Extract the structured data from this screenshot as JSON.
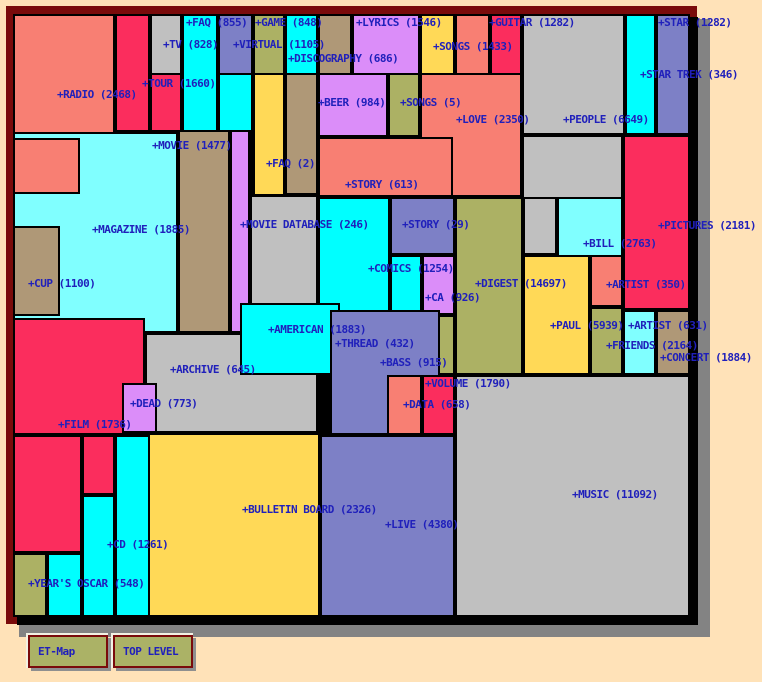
{
  "page": {
    "background": "#ffe2b8"
  },
  "toolbar": {
    "etmap_label": "ET-Map",
    "toplevel_label": "TOP LEVEL"
  },
  "map": {
    "frame_color": "#7a0b0b",
    "shadow_color": "#838383",
    "label_color": "#2020bb",
    "palette": {
      "salmon": "#f87f73",
      "crimson": "#fb2d5d",
      "gray": "#c0c0c0",
      "cyan": "#00ffff",
      "lcyan": "#80ffff",
      "violet": "#db8df9",
      "slate": "#7d80c6",
      "olive": "#acb164",
      "gold": "#ffd957",
      "tan": "#af9877"
    },
    "tiles": [
      {
        "name": "radio",
        "x": 13,
        "y": 14,
        "w": 102,
        "h": 126,
        "c": "salmon"
      },
      {
        "name": "magazine",
        "x": 13,
        "y": 132,
        "w": 165,
        "h": 201,
        "c": "lcyan"
      },
      {
        "name": "radio-lower",
        "x": 13,
        "y": 138,
        "w": 67,
        "h": 56,
        "c": "salmon"
      },
      {
        "name": "cup",
        "x": 13,
        "y": 226,
        "w": 47,
        "h": 90,
        "c": "tan"
      },
      {
        "name": "tour",
        "x": 115,
        "y": 14,
        "w": 35,
        "h": 118,
        "c": "crimson"
      },
      {
        "name": "tv",
        "x": 150,
        "y": 14,
        "w": 32,
        "h": 61,
        "c": "gray"
      },
      {
        "name": "tour-right",
        "x": 150,
        "y": 73,
        "w": 32,
        "h": 59,
        "c": "crimson"
      },
      {
        "name": "faq-855",
        "x": 182,
        "y": 14,
        "w": 36,
        "h": 118,
        "c": "cyan"
      },
      {
        "name": "virtual",
        "x": 218,
        "y": 14,
        "w": 35,
        "h": 61,
        "c": "slate"
      },
      {
        "name": "virtual-lower",
        "x": 218,
        "y": 73,
        "w": 35,
        "h": 59,
        "c": "cyan"
      },
      {
        "name": "game",
        "x": 253,
        "y": 14,
        "w": 32,
        "h": 61,
        "c": "olive"
      },
      {
        "name": "game-right",
        "x": 285,
        "y": 14,
        "w": 33,
        "h": 61,
        "c": "cyan"
      },
      {
        "name": "discography-top",
        "x": 318,
        "y": 14,
        "w": 34,
        "h": 61,
        "c": "tan"
      },
      {
        "name": "lyrics",
        "x": 352,
        "y": 14,
        "w": 68,
        "h": 61,
        "c": "violet"
      },
      {
        "name": "songs-1433",
        "x": 420,
        "y": 14,
        "w": 35,
        "h": 61,
        "c": "gold"
      },
      {
        "name": "songs-right",
        "x": 455,
        "y": 14,
        "w": 35,
        "h": 61,
        "c": "salmon"
      },
      {
        "name": "guitar",
        "x": 490,
        "y": 14,
        "w": 32,
        "h": 61,
        "c": "crimson"
      },
      {
        "name": "people",
        "x": 522,
        "y": 14,
        "w": 103,
        "h": 121,
        "c": "gray"
      },
      {
        "name": "people-cyan-strip",
        "x": 625,
        "y": 14,
        "w": 31,
        "h": 121,
        "c": "cyan"
      },
      {
        "name": "star",
        "x": 656,
        "y": 14,
        "w": 34,
        "h": 121,
        "c": "slate"
      },
      {
        "name": "faq-2",
        "x": 253,
        "y": 73,
        "w": 32,
        "h": 123,
        "c": "gold"
      },
      {
        "name": "discography",
        "x": 285,
        "y": 73,
        "w": 33,
        "h": 122,
        "c": "tan"
      },
      {
        "name": "beer",
        "x": 318,
        "y": 73,
        "w": 70,
        "h": 64,
        "c": "violet"
      },
      {
        "name": "songs-5",
        "x": 388,
        "y": 73,
        "w": 32,
        "h": 64,
        "c": "olive"
      },
      {
        "name": "love",
        "x": 420,
        "y": 73,
        "w": 102,
        "h": 124,
        "c": "salmon"
      },
      {
        "name": "movie",
        "x": 178,
        "y": 130,
        "w": 52,
        "h": 203,
        "c": "tan"
      },
      {
        "name": "movie-database-col",
        "x": 230,
        "y": 130,
        "w": 20,
        "h": 203,
        "c": "violet"
      },
      {
        "name": "movie-database",
        "x": 250,
        "y": 195,
        "w": 68,
        "h": 138,
        "c": "gray"
      },
      {
        "name": "story-613",
        "x": 318,
        "y": 137,
        "w": 135,
        "h": 60,
        "c": "salmon"
      },
      {
        "name": "people-lower",
        "x": 522,
        "y": 135,
        "w": 101,
        "h": 75,
        "c": "gray"
      },
      {
        "name": "pictures",
        "x": 623,
        "y": 135,
        "w": 67,
        "h": 175,
        "c": "crimson"
      },
      {
        "name": "comics",
        "x": 318,
        "y": 197,
        "w": 72,
        "h": 118,
        "c": "cyan"
      },
      {
        "name": "comics-ext",
        "x": 390,
        "y": 255,
        "w": 32,
        "h": 60,
        "c": "cyan"
      },
      {
        "name": "story-29",
        "x": 390,
        "y": 197,
        "w": 65,
        "h": 58,
        "c": "slate"
      },
      {
        "name": "ca",
        "x": 422,
        "y": 255,
        "w": 33,
        "h": 60,
        "c": "violet"
      },
      {
        "name": "digest",
        "x": 455,
        "y": 197,
        "w": 68,
        "h": 178,
        "c": "olive"
      },
      {
        "name": "digest-ext",
        "x": 422,
        "y": 315,
        "w": 33,
        "h": 60,
        "c": "olive"
      },
      {
        "name": "people-tongue",
        "x": 523,
        "y": 197,
        "w": 34,
        "h": 58,
        "c": "gray"
      },
      {
        "name": "bill",
        "x": 557,
        "y": 197,
        "w": 66,
        "h": 110,
        "c": "lcyan"
      },
      {
        "name": "paul",
        "x": 523,
        "y": 255,
        "w": 67,
        "h": 120,
        "c": "gold"
      },
      {
        "name": "artist-350",
        "x": 590,
        "y": 255,
        "w": 33,
        "h": 52,
        "c": "salmon"
      },
      {
        "name": "artist-631",
        "x": 590,
        "y": 307,
        "w": 33,
        "h": 68,
        "c": "olive"
      },
      {
        "name": "friends",
        "x": 623,
        "y": 310,
        "w": 33,
        "h": 65,
        "c": "lcyan"
      },
      {
        "name": "concert",
        "x": 656,
        "y": 310,
        "w": 34,
        "h": 65,
        "c": "tan"
      },
      {
        "name": "film",
        "x": 13,
        "y": 318,
        "w": 132,
        "h": 117,
        "c": "crimson"
      },
      {
        "name": "film-lower",
        "x": 13,
        "y": 435,
        "w": 69,
        "h": 118,
        "c": "crimson"
      },
      {
        "name": "film-step",
        "x": 82,
        "y": 435,
        "w": 33,
        "h": 60,
        "c": "crimson"
      },
      {
        "name": "archive",
        "x": 145,
        "y": 333,
        "w": 173,
        "h": 100,
        "c": "gray"
      },
      {
        "name": "american",
        "x": 240,
        "y": 303,
        "w": 100,
        "h": 72,
        "c": "cyan"
      },
      {
        "name": "dead",
        "x": 122,
        "y": 383,
        "w": 35,
        "h": 50,
        "c": "violet"
      },
      {
        "name": "thread-bass",
        "x": 330,
        "y": 310,
        "w": 110,
        "h": 125,
        "c": "slate"
      },
      {
        "name": "data",
        "x": 387,
        "y": 375,
        "w": 35,
        "h": 60,
        "c": "salmon"
      },
      {
        "name": "volume",
        "x": 422,
        "y": 375,
        "w": 33,
        "h": 60,
        "c": "crimson"
      },
      {
        "name": "music",
        "x": 455,
        "y": 375,
        "w": 235,
        "h": 242,
        "c": "gray"
      },
      {
        "name": "bulletin-board",
        "x": 145,
        "y": 433,
        "w": 175,
        "h": 184,
        "c": "gold"
      },
      {
        "name": "live",
        "x": 320,
        "y": 435,
        "w": 135,
        "h": 182,
        "c": "slate"
      },
      {
        "name": "cd",
        "x": 115,
        "y": 435,
        "w": 35,
        "h": 182,
        "c": "cyan"
      },
      {
        "name": "cd-step",
        "x": 82,
        "y": 495,
        "w": 33,
        "h": 122,
        "c": "cyan"
      },
      {
        "name": "cd-step2",
        "x": 47,
        "y": 553,
        "w": 35,
        "h": 64,
        "c": "cyan"
      },
      {
        "name": "years-oscar",
        "x": 13,
        "y": 553,
        "w": 34,
        "h": 64,
        "c": "olive"
      }
    ],
    "labels": [
      {
        "name": "faq-855",
        "text": "+FAQ (855)",
        "x": 186,
        "y": 16
      },
      {
        "name": "game",
        "text": "+GAME (848)",
        "x": 255,
        "y": 16
      },
      {
        "name": "lyrics",
        "text": "+LYRICS (1546)",
        "x": 356,
        "y": 16
      },
      {
        "name": "guitar",
        "text": "+GUITAR (1282)",
        "x": 489,
        "y": 16
      },
      {
        "name": "star",
        "text": "+STAR (1282)",
        "x": 658,
        "y": 16
      },
      {
        "name": "tv",
        "text": "+TV (828)",
        "x": 163,
        "y": 38
      },
      {
        "name": "virtual",
        "text": "+VIRTUAL (1105)",
        "x": 233,
        "y": 38
      },
      {
        "name": "songs-1433",
        "text": "+SONGS (1433)",
        "x": 433,
        "y": 40
      },
      {
        "name": "discography",
        "text": "+DISCOGRAPHY (686)",
        "x": 288,
        "y": 52
      },
      {
        "name": "star-trek",
        "text": "+STAR TREK (346)",
        "x": 640,
        "y": 68
      },
      {
        "name": "tour",
        "text": "+TOUR (1660)",
        "x": 142,
        "y": 77
      },
      {
        "name": "beer",
        "text": "+BEER (984)",
        "x": 318,
        "y": 96
      },
      {
        "name": "songs-5",
        "text": "+SONGS (5)",
        "x": 400,
        "y": 96
      },
      {
        "name": "love",
        "text": "+LOVE (2350)",
        "x": 456,
        "y": 113
      },
      {
        "name": "people",
        "text": "+PEOPLE (6649)",
        "x": 563,
        "y": 113
      },
      {
        "name": "movie",
        "text": "+MOVIE (1477)",
        "x": 152,
        "y": 139
      },
      {
        "name": "faq-2",
        "text": "+FAQ (2)",
        "x": 266,
        "y": 157
      },
      {
        "name": "story-613",
        "text": "+STORY (613)",
        "x": 345,
        "y": 178
      },
      {
        "name": "movie-database",
        "text": "+MOVIE DATABASE (246)",
        "x": 240,
        "y": 218
      },
      {
        "name": "story-29",
        "text": "+STORY (29)",
        "x": 402,
        "y": 218
      },
      {
        "name": "pictures",
        "text": "+PICTURES (2181)",
        "x": 658,
        "y": 219
      },
      {
        "name": "magazine",
        "text": "+MAGAZINE (1885)",
        "x": 92,
        "y": 223
      },
      {
        "name": "bill",
        "text": "+BILL (2763)",
        "x": 583,
        "y": 237
      },
      {
        "name": "comics",
        "text": "+COMICS (1254)",
        "x": 368,
        "y": 262
      },
      {
        "name": "cup",
        "text": "+CUP (1100)",
        "x": 28,
        "y": 277
      },
      {
        "name": "digest",
        "text": "+DIGEST (14697)",
        "x": 475,
        "y": 277
      },
      {
        "name": "artist-350",
        "text": "+ARTIST (350)",
        "x": 606,
        "y": 278
      },
      {
        "name": "ca",
        "text": "+CA (926)",
        "x": 425,
        "y": 291
      },
      {
        "name": "radio",
        "text": "+RADIO (2468)",
        "x": 57,
        "y": 88
      },
      {
        "name": "paul",
        "text": "+PAUL (5939)",
        "x": 550,
        "y": 319
      },
      {
        "name": "artist-631",
        "text": "+ARTIST (631)",
        "x": 628,
        "y": 319
      },
      {
        "name": "american",
        "text": "+AMERICAN (1883)",
        "x": 268,
        "y": 323
      },
      {
        "name": "thread",
        "text": "+THREAD (432)",
        "x": 335,
        "y": 337
      },
      {
        "name": "friends",
        "text": "+FRIENDS (2164)",
        "x": 606,
        "y": 339
      },
      {
        "name": "concert",
        "text": "+CONCERT (1884)",
        "x": 660,
        "y": 351
      },
      {
        "name": "bass",
        "text": "+BASS (915)",
        "x": 380,
        "y": 356
      },
      {
        "name": "archive",
        "text": "+ARCHIVE (645)",
        "x": 170,
        "y": 363
      },
      {
        "name": "volume",
        "text": "+VOLUME (1790)",
        "x": 425,
        "y": 377
      },
      {
        "name": "dead",
        "text": "+DEAD (773)",
        "x": 130,
        "y": 397
      },
      {
        "name": "data",
        "text": "+DATA (658)",
        "x": 403,
        "y": 398
      },
      {
        "name": "film",
        "text": "+FILM (1736)",
        "x": 58,
        "y": 418
      },
      {
        "name": "music",
        "text": "+MUSIC (11092)",
        "x": 572,
        "y": 488
      },
      {
        "name": "bulletin-board",
        "text": "+BULLETIN BOARD (2326)",
        "x": 242,
        "y": 503
      },
      {
        "name": "live",
        "text": "+LIVE (4380)",
        "x": 385,
        "y": 518
      },
      {
        "name": "cd",
        "text": "+CD (1261)",
        "x": 107,
        "y": 538
      },
      {
        "name": "years-oscar",
        "text": "+YEAR'S OSCAR (548)",
        "x": 28,
        "y": 577
      }
    ]
  }
}
